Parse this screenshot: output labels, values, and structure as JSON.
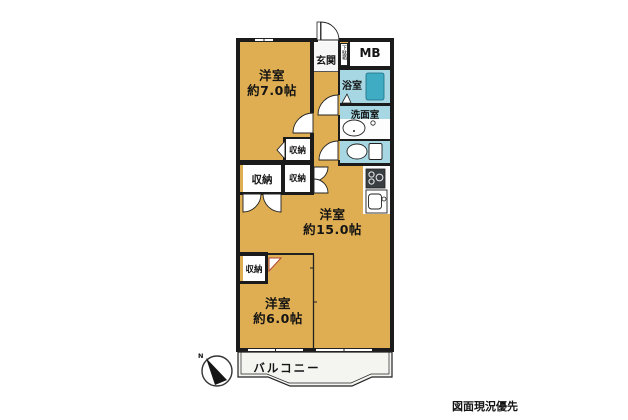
{
  "plan": {
    "rooms": {
      "bedroom_top": {
        "name": "洋室",
        "size": "約7.0帖"
      },
      "living": {
        "name": "洋室",
        "size": "約15.0帖"
      },
      "bedroom_bottom": {
        "name": "洋室",
        "size": "約6.0帖"
      },
      "entrance": {
        "label": "玄関"
      },
      "shoe_box": {
        "label": "下駄箱"
      },
      "meter_box": {
        "label": "MB"
      },
      "bathroom": {
        "label": "浴室"
      },
      "washroom": {
        "label": "洗面室"
      },
      "closet_hall_upper": {
        "label": "収納"
      },
      "closet_hall_left": {
        "label": "収納"
      },
      "closet_hall_right": {
        "label": "収納"
      },
      "closet_bedroom": {
        "label": "収納"
      },
      "balcony": {
        "label": "バルコニー"
      }
    },
    "compass": {
      "north_label": "N"
    },
    "note": "図面現況優先",
    "colors": {
      "room_fill": "#DFAE52",
      "wet_fill": "#A6D7E2",
      "tub_fill": "#3FACC4",
      "wall": "#1B1B1B",
      "balcony_fill": "#F4F4F1",
      "door_accent": "#B24436"
    }
  }
}
